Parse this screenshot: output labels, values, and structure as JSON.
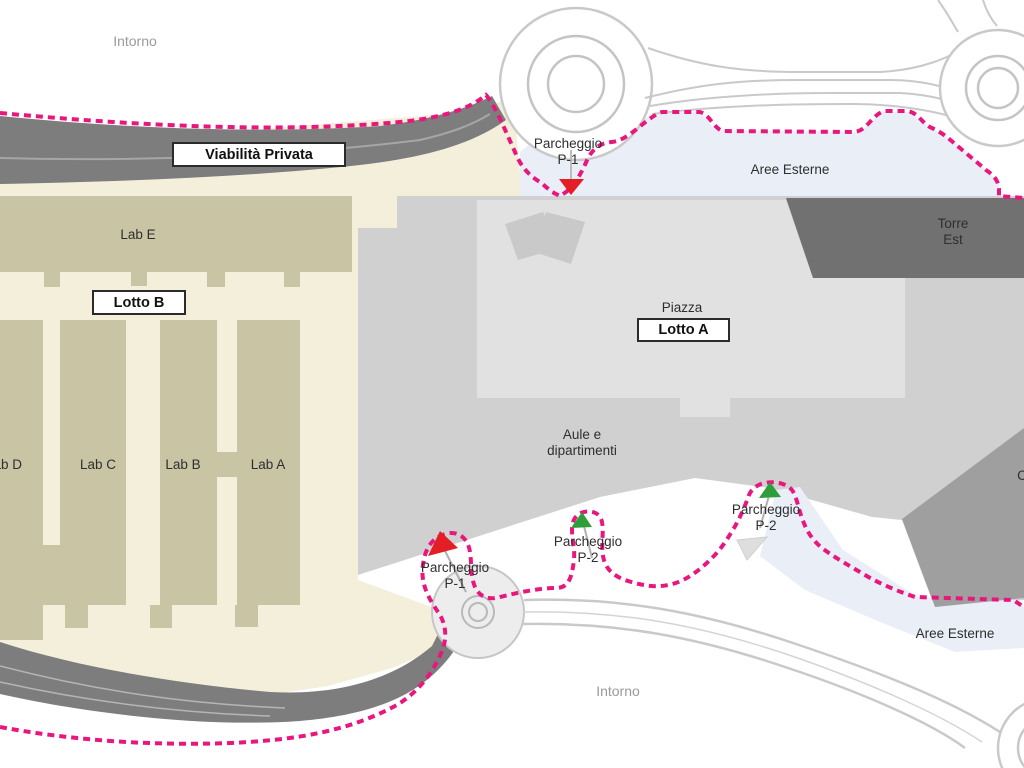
{
  "map": {
    "title_hint": "Campus site plan (Lotto A / Lotto B)",
    "labels": {
      "intorno_top": "Intorno",
      "intorno_bottom": "Intorno",
      "viabilita_privata": "Viabilità Privata",
      "parcheggio_p1_top": {
        "line1": "Parcheggio",
        "line2": "P-1"
      },
      "parcheggio_p1_bottom": {
        "line1": "Parcheggio",
        "line2": "P-1"
      },
      "parcheggio_p2_mid": {
        "line1": "Parcheggio",
        "line2": "P-2"
      },
      "parcheggio_p2_right": {
        "line1": "Parcheggio",
        "line2": "P-2"
      },
      "aree_esterne_top": "Aree Esterne",
      "aree_esterne_bottom": "Aree Esterne",
      "torre_est": {
        "line1": "Torre",
        "line2": "Est"
      },
      "lab_e": "Lab E",
      "lab_d": "Lab D",
      "lab_c": "Lab C",
      "lab_b": "Lab B",
      "lab_a": "Lab A",
      "lotto_b": "Lotto B",
      "lotto_a": "Lotto A",
      "piazza": "Piazza",
      "aule": {
        "line1": "Aule e",
        "line2": "dipartimenti"
      },
      "partial_label": "C"
    },
    "colors": {
      "boundary-pink": "#e9167e",
      "road-dark": "#7d7d7d",
      "road-line": "#a6a6a6",
      "road-light-edge": "#c9c9c9",
      "paving": "#d0d0d0",
      "piazza-light": "#e1e1e1",
      "piazza-quad": "#c9c9c9",
      "cream": "#f3efdb",
      "building-tan": "#c9c4a4",
      "building-dark": "#717171",
      "building-medium": "#9f9f9f",
      "area-blue": "#e9eef7",
      "marker-red": "#e31e24",
      "marker-green": "#2e9e3c",
      "roundabout-fill": "#ededed"
    }
  }
}
